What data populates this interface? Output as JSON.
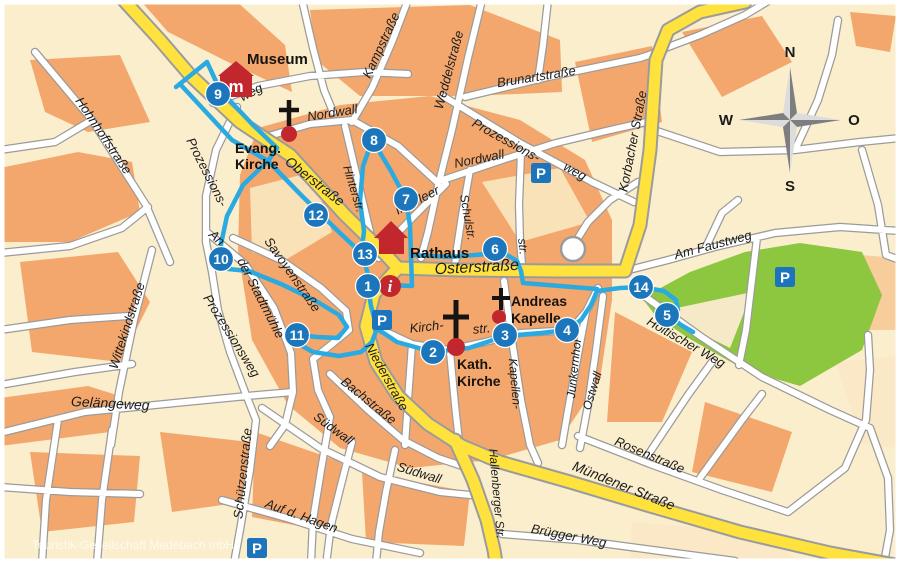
{
  "map": {
    "watermark": "Touristik-Gesellschaft Medebach mbH",
    "parking_label": "P",
    "compass": {
      "north": "N",
      "west": "W",
      "east": "O",
      "south": "S"
    },
    "colors": {
      "route": "#2BA9E1",
      "stop": "#1B76BC",
      "main_road": "#FFE23E",
      "park": "#8DC63F",
      "landmark": "#C1272D",
      "parking": "#1C75BC"
    },
    "landmarks": {
      "museum": {
        "label": "Museum",
        "icon_letter": "m"
      },
      "evang_kirche": {
        "line1": "Evang.",
        "line2": "Kirche"
      },
      "rathaus": {
        "label": "Rathaus"
      },
      "kath_kirche": {
        "line1": "Kath.",
        "line2": "Kirche"
      },
      "andreas_kapelle": {
        "line1": "Andreas",
        "line2": "Kapelle"
      },
      "info": {
        "label": "i"
      }
    },
    "tour_stops": [
      {
        "number": "1"
      },
      {
        "number": "2"
      },
      {
        "number": "3"
      },
      {
        "number": "4"
      },
      {
        "number": "5"
      },
      {
        "number": "6"
      },
      {
        "number": "7"
      },
      {
        "number": "8"
      },
      {
        "number": "9"
      },
      {
        "number": "10"
      },
      {
        "number": "11"
      },
      {
        "number": "12"
      },
      {
        "number": "13"
      },
      {
        "number": "14"
      }
    ],
    "streets": [
      {
        "name": "Hohnhoffstraße"
      },
      {
        "name": "Kampstraße"
      },
      {
        "name": "Weddelstraße"
      },
      {
        "name": "Brunartstraße"
      },
      {
        "name": "Nordwall"
      },
      {
        "name": "Nordwall"
      },
      {
        "name": "Hinterstr."
      },
      {
        "name": "Prozessions-"
      },
      {
        "name": "weg"
      },
      {
        "name": "Korbacher Straße"
      },
      {
        "name": "Am Faustweg"
      },
      {
        "name": "Holtischer Weg"
      },
      {
        "name": "Oberstraße"
      },
      {
        "name": "Im Meer"
      },
      {
        "name": "Schulstr."
      },
      {
        "name": "str."
      },
      {
        "name": "Osterstraße"
      },
      {
        "name": "Savoyenstraße"
      },
      {
        "name": "An"
      },
      {
        "name": "der Stadtmühle"
      },
      {
        "name": "Prozessions-"
      },
      {
        "name": "Prozessionsweg"
      },
      {
        "name": "Wittekindstraße"
      },
      {
        "name": "Gelängeweg"
      },
      {
        "name": "Schützenstraße"
      },
      {
        "name": "Auf d. Hagen"
      },
      {
        "name": "Südwall"
      },
      {
        "name": "Bachstraße"
      },
      {
        "name": "Südwall"
      },
      {
        "name": "Niederstraße"
      },
      {
        "name": "Hallenberger Str."
      },
      {
        "name": "Brügger Weg"
      },
      {
        "name": "Mündener Straße"
      },
      {
        "name": "Rosenstraße"
      },
      {
        "name": "Kapellen-"
      },
      {
        "name": "Junkernhof"
      },
      {
        "name": "Ostwall"
      },
      {
        "name": "Kirch-"
      },
      {
        "name": "str."
      },
      {
        "name": "weg"
      }
    ]
  }
}
